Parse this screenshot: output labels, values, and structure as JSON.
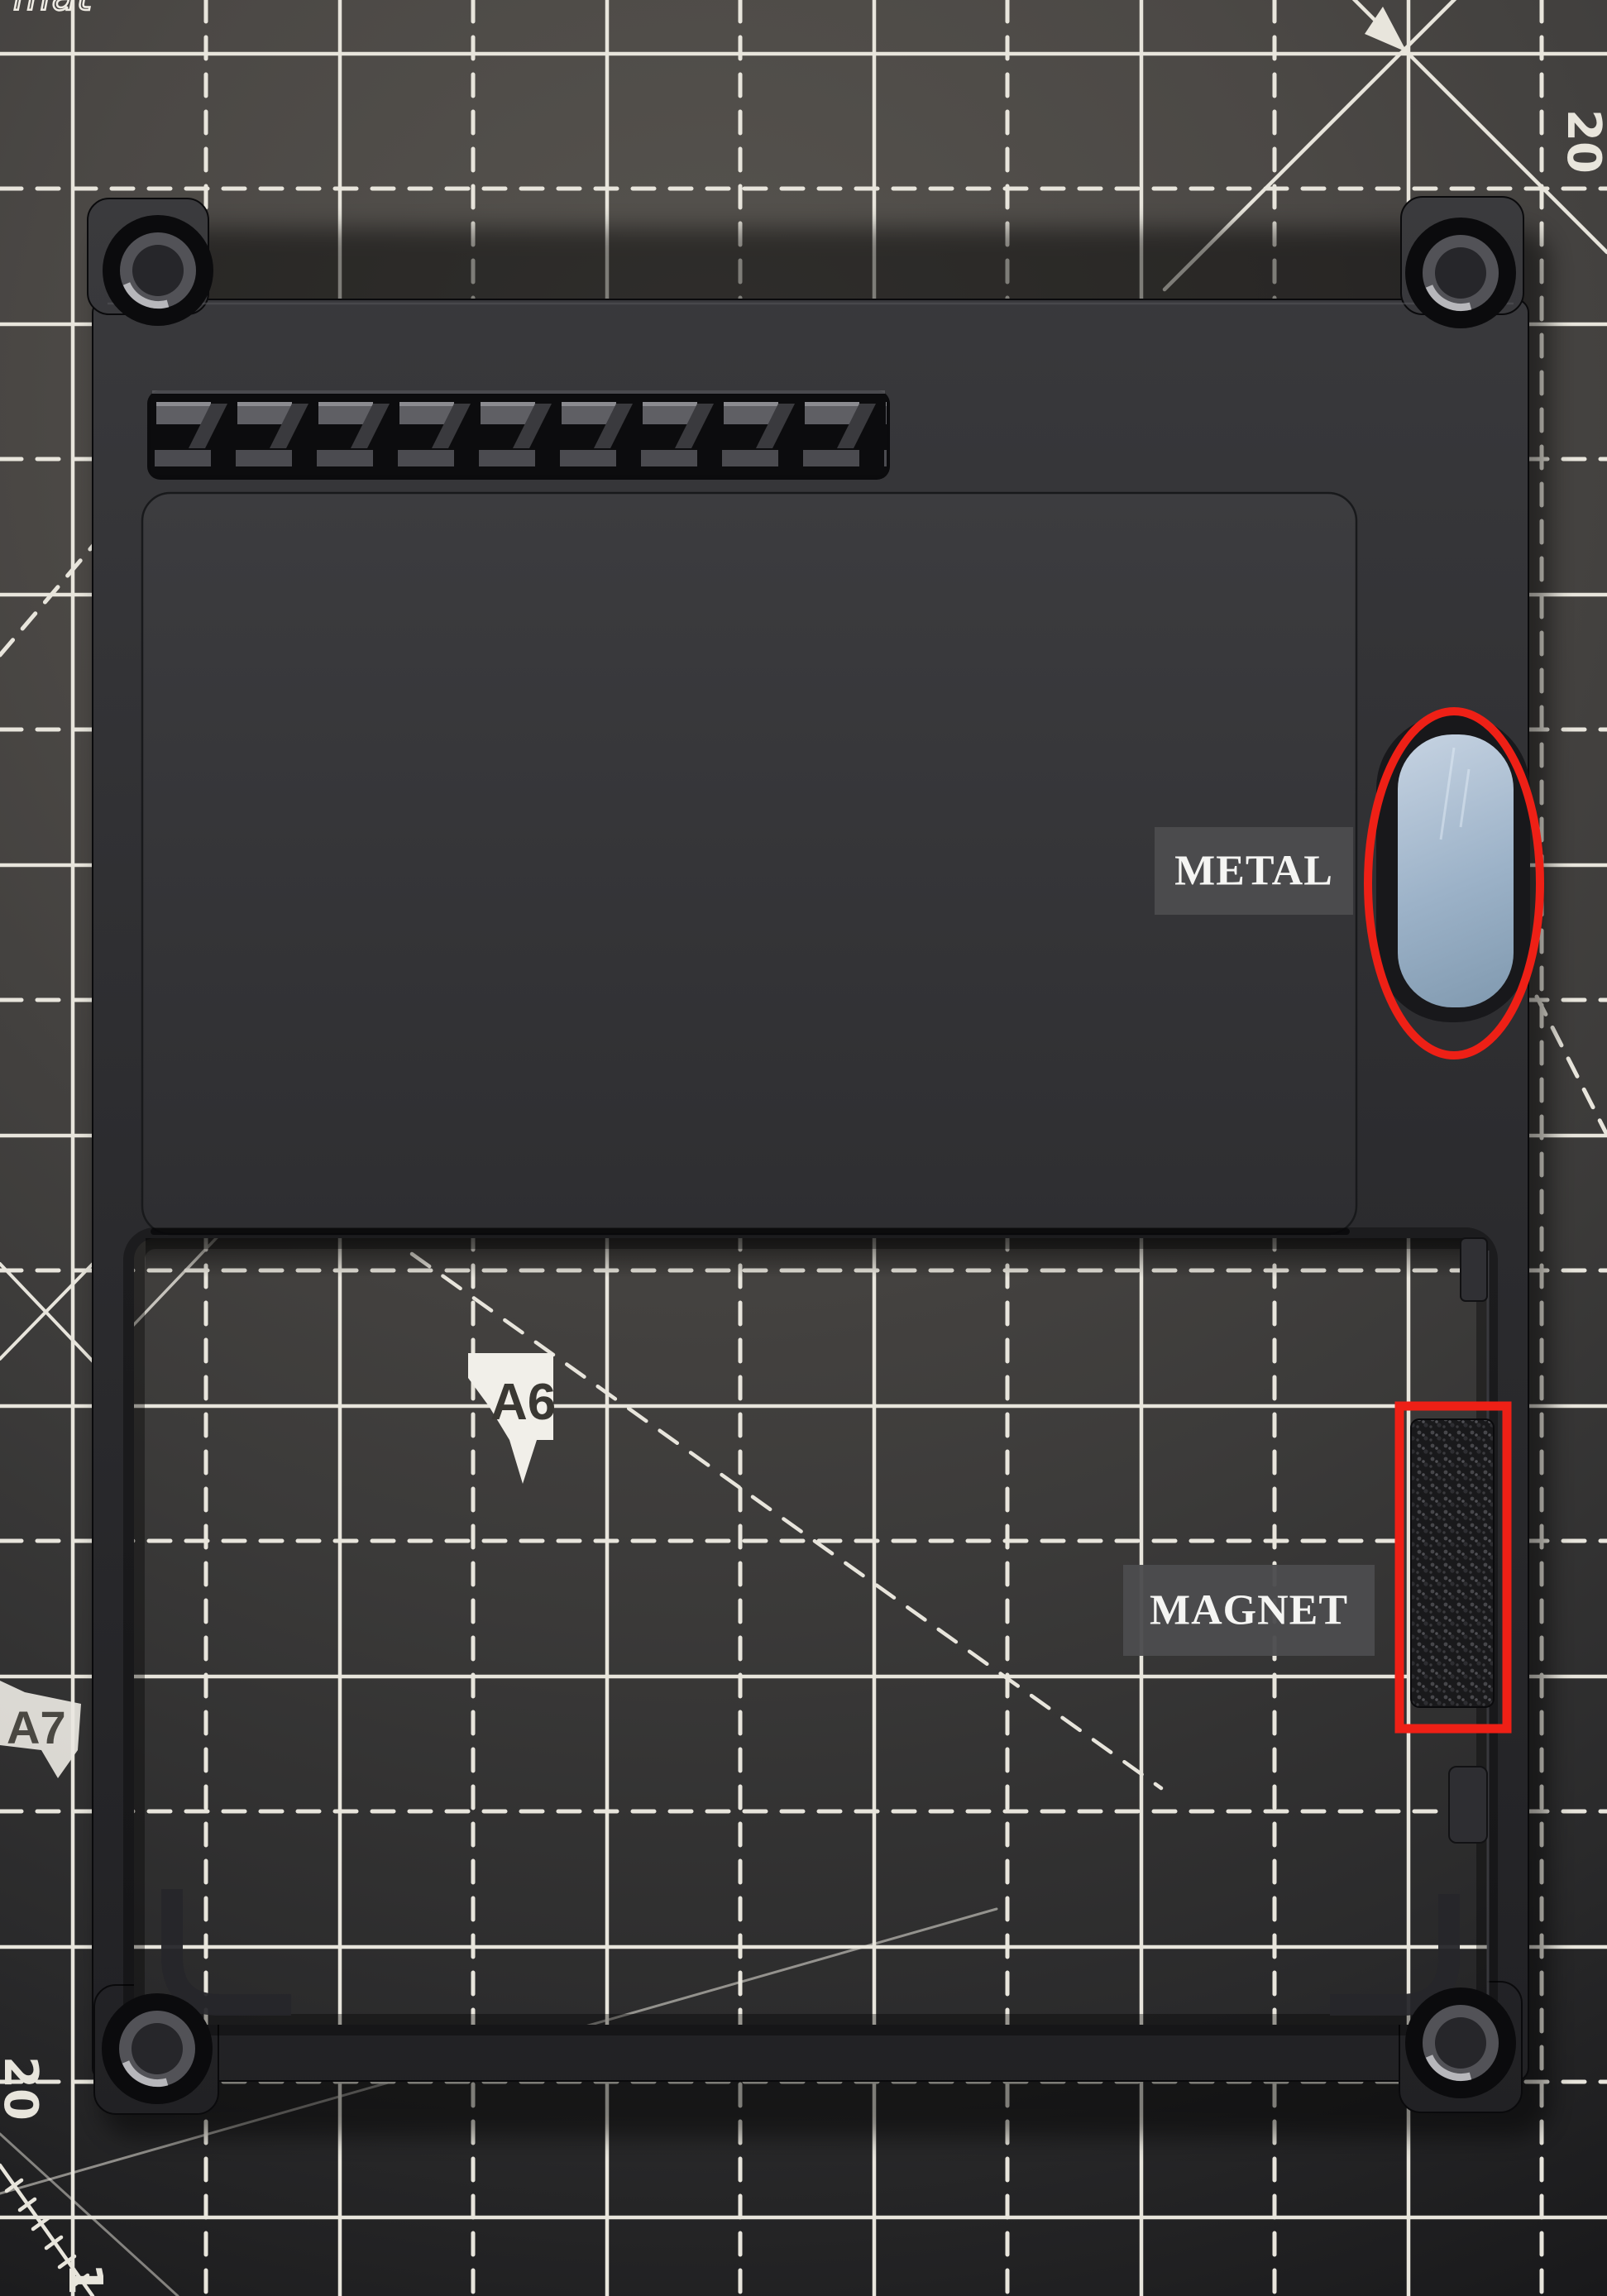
{
  "mat": {
    "brand_text_partial": "mat",
    "marker_a6": "A6",
    "marker_a7": "A7",
    "number_top_right": "20",
    "number_bottom_left_upper": "20",
    "number_bottom_left_lower": "10",
    "grid_line_color": "#e8e5dc",
    "surface_color": "#4a4845"
  },
  "device": {
    "frame_color": "#2d2d30",
    "metal_plate_color": "#a9bed2"
  },
  "annotations": {
    "metal": {
      "label": "METAL"
    },
    "magnet": {
      "label": "MAGNET"
    },
    "highlight_color": "#ee2016",
    "label_background": "#4c4c4e",
    "label_text_color": "#f5f5f3"
  }
}
